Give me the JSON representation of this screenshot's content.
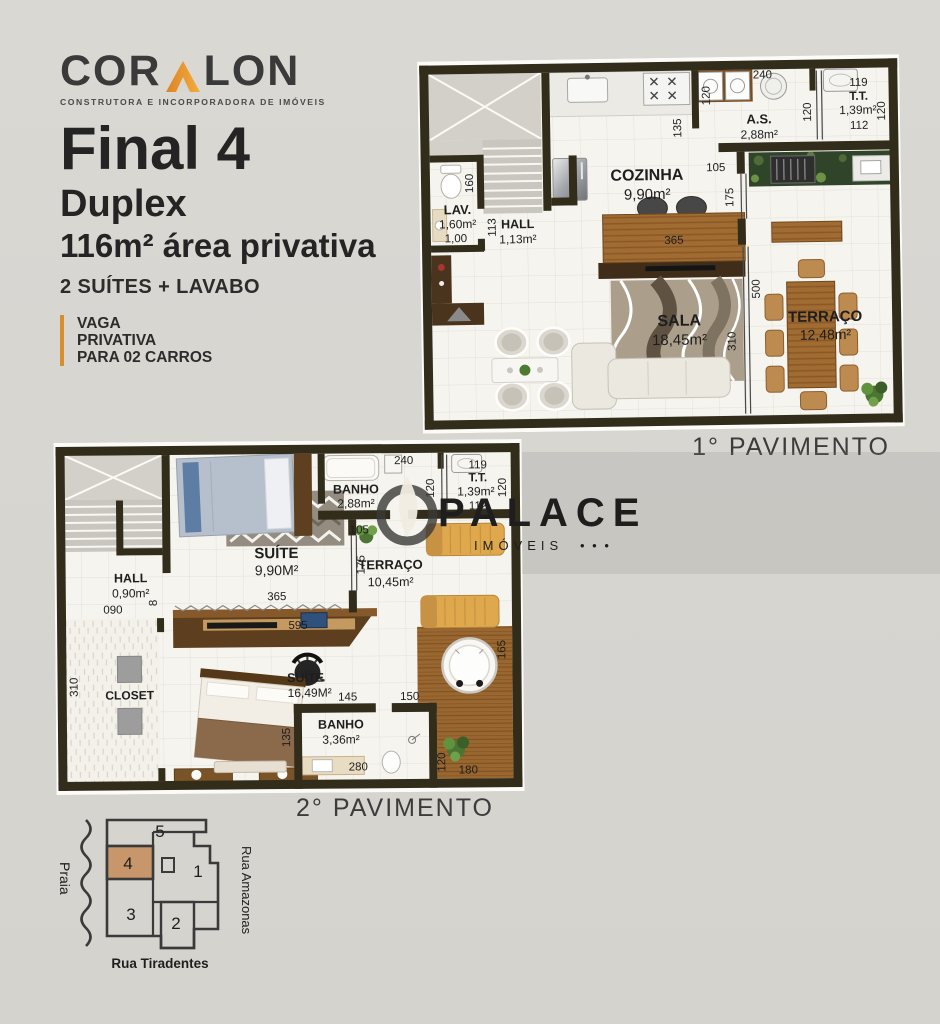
{
  "brand": {
    "logo_pre": "COR",
    "logo_post": "LON",
    "tagline": "CONSTRUTORA E INCORPORADORA DE IMÓVEIS",
    "title": "Final 4",
    "subtitle": "Duplex",
    "area_line": "116m² área privativa",
    "features": "2 SUÍTES + LAVABO",
    "parking_line1": "VAGA",
    "parking_line2": "PRIVATIVA",
    "parking_line3": "PARA 02 CARROS",
    "accent_orange": "#d98e2e"
  },
  "floor1": {
    "caption": "1° PAVIMENTO",
    "lav": "LAV.",
    "lav_area": "1,60m²",
    "lav_width": "1,00",
    "hall": "HALL",
    "hall_area": "1,13m²",
    "cozinha": "COZINHA",
    "cozinha_area": "9,90m²",
    "as": "A.S.",
    "as_area": "2,88m²",
    "tt": "T.T.",
    "tt_area": "1,39m²",
    "sala": "SALA",
    "sala_area": "18,45m²",
    "terraco": "TERRAÇO",
    "terraco_area": "12,48m²",
    "d160": "160",
    "d113": "113",
    "d135": "135",
    "d365": "365",
    "d105": "105",
    "d175": "175",
    "d120_as": "120",
    "d240": "240",
    "d119": "119",
    "d112": "112",
    "d120_tt_l": "120",
    "d120_tt_r": "120",
    "d500": "500",
    "d310": "310"
  },
  "floor2": {
    "caption": "2° PAVIMENTO",
    "hall": "HALL",
    "hall_area": "0,90m²",
    "d090": "090",
    "d8": "8",
    "suite1": "SUÍTE",
    "suite1_area": "9,90M²",
    "d365": "365",
    "banho1": "BANHO",
    "banho1_area": "2,88m²",
    "d240": "240",
    "d120_banho": "120",
    "tt": "T.T.",
    "tt_area": "1,39m²",
    "d119": "119",
    "d112": "112",
    "d120_tt": "120",
    "d105": "105",
    "d175": "175",
    "terraco": "TERRAÇO",
    "terraco_area": "10,45m²",
    "d595": "595",
    "closet": "CLOSET",
    "d310": "310",
    "suite2": "SUÍTE",
    "suite2_area": "16,49M²",
    "d145": "145",
    "d150": "150",
    "d135": "135",
    "banho2": "BANHO",
    "banho2_area": "3,36m²",
    "d280": "280",
    "d120_banho2": "120",
    "d165": "165",
    "d180": "180"
  },
  "watermark": {
    "name": "PALACE",
    "category": "IMÓVEIS",
    "dots": "• • •"
  },
  "sitemap": {
    "street_left": "Praia",
    "street_right": "Rua Amazonas",
    "street_bottom": "Rua Tiradentes",
    "unit1": "1",
    "unit2": "2",
    "unit3": "3",
    "unit4": "4",
    "unit5": "5",
    "highlight_color": "#c8966b"
  }
}
